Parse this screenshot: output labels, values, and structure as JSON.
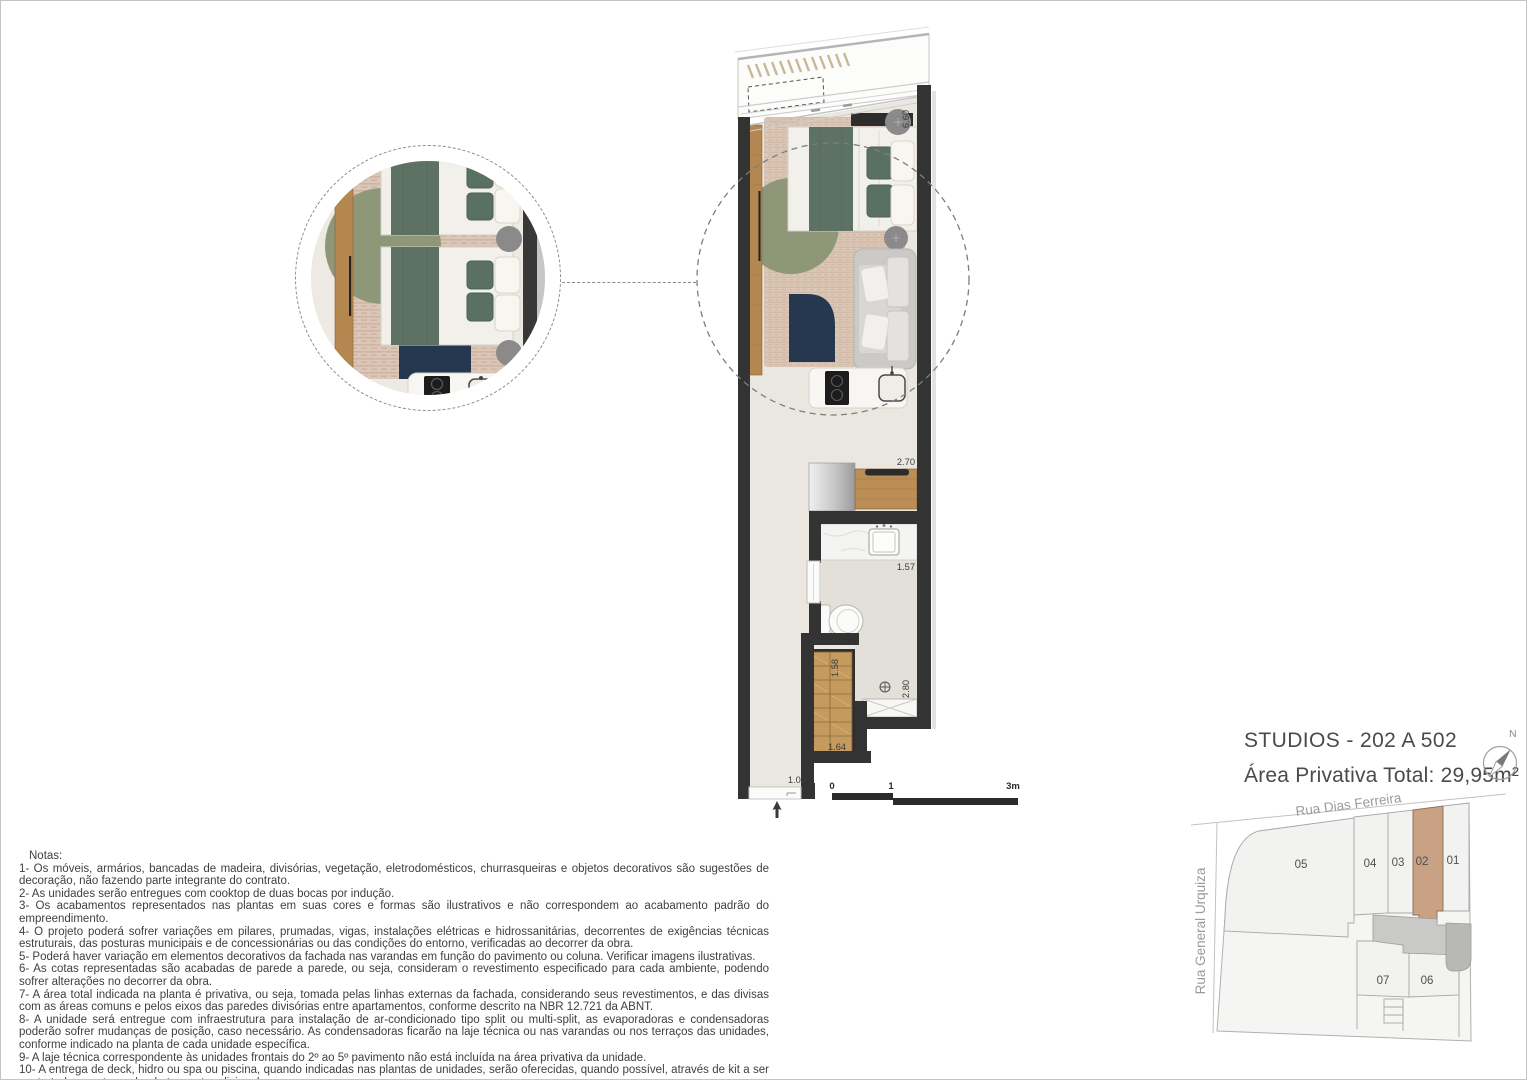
{
  "title": {
    "line1": "STUDIOS - 202 A 502",
    "line2": "Área Privativa Total: 29,95m²"
  },
  "compass": {
    "north_label": "N"
  },
  "plan": {
    "dimensions": {
      "total_height": "6.60",
      "kitchen_counter": "2.70",
      "bath_counter": "1.57",
      "closet_side": "1.58",
      "closet_front": "1.64",
      "bath_length": "2.80",
      "entry_door": "1.00"
    },
    "scale_bar": {
      "tick0": "0",
      "tick1": "1",
      "tick2": "3m"
    }
  },
  "keyplan": {
    "streets": {
      "top": "Rua Dias Ferreira",
      "left": "Rua General Urquiza"
    },
    "unit_labels": [
      "05",
      "04",
      "03",
      "02",
      "01",
      "07",
      "06"
    ],
    "highlighted_unit": "02",
    "highlight_color": "#c9a184"
  },
  "notes": {
    "heading": "Notas:",
    "items": [
      "1- Os móveis, armários, bancadas de madeira, divisórias, vegetação, eletrodomésticos, churrasqueiras e objetos decorativos são sugestões de decoração, não fazendo parte integrante do contrato.",
      "2- As unidades serão entregues com cooktop de duas bocas por indução.",
      "3- Os acabamentos  representados nas plantas em suas cores e formas são ilustrativos e não  correspondem ao acabamento padrão do  empreendimento.",
      "4- O projeto poderá sofrer variações em pilares,  prumadas,  vigas,  instalações elétricas e hidrossanitárias,  decorrentes de exigências técnicas estruturais, das posturas municipais e de concessionárias ou das condições do entorno, verificadas ao decorrer da obra.",
      "5- Poderá haver variação em elementos decorativos da fachada nas varandas em função do pavimento ou coluna. Verificar imagens ilustrativas.",
      "6- As cotas  representadas  são  acabadas  de parede a  parede, ou seja,  consideram o revestimento  especificado para cada  ambiente,  podendo  sofrer alterações no decorrer da obra.",
      "7- A área  total indicada  na planta é privativa, ou seja,  tomada pelas linhas externas da fachada,  considerando seus revestimentos, e das divisas  com as áreas comuns e pelos eixos das paredes divisórias entre apartamentos, conforme descrito na NBR 12.721 da ABNT.",
      "8- A unidade será entregue com infraestrutura para instalação de ar-condicionado tipo split ou multi-split, as evaporadoras e condensadoras poderão sofrer mudanças  de posição, caso necessário.  As condensadoras ficarão na laje técnica ou  nas varandas ou nos terraços das unidades,  conforme indicado na planta de cada unidade específica.",
      "9- A laje técnica correspondente às unidades frontais do 2º ao 5º pavimento não está incluída na área privativa da unidade.",
      "10- A  entrega  de  deck,  hidro ou spa ou piscina,  quando  indicadas  nas plantas de unidades,  serão  oferecidas,  quando  possível,  através  de kit a  ser contratado a parte, podendo ter custo adicional."
    ]
  }
}
